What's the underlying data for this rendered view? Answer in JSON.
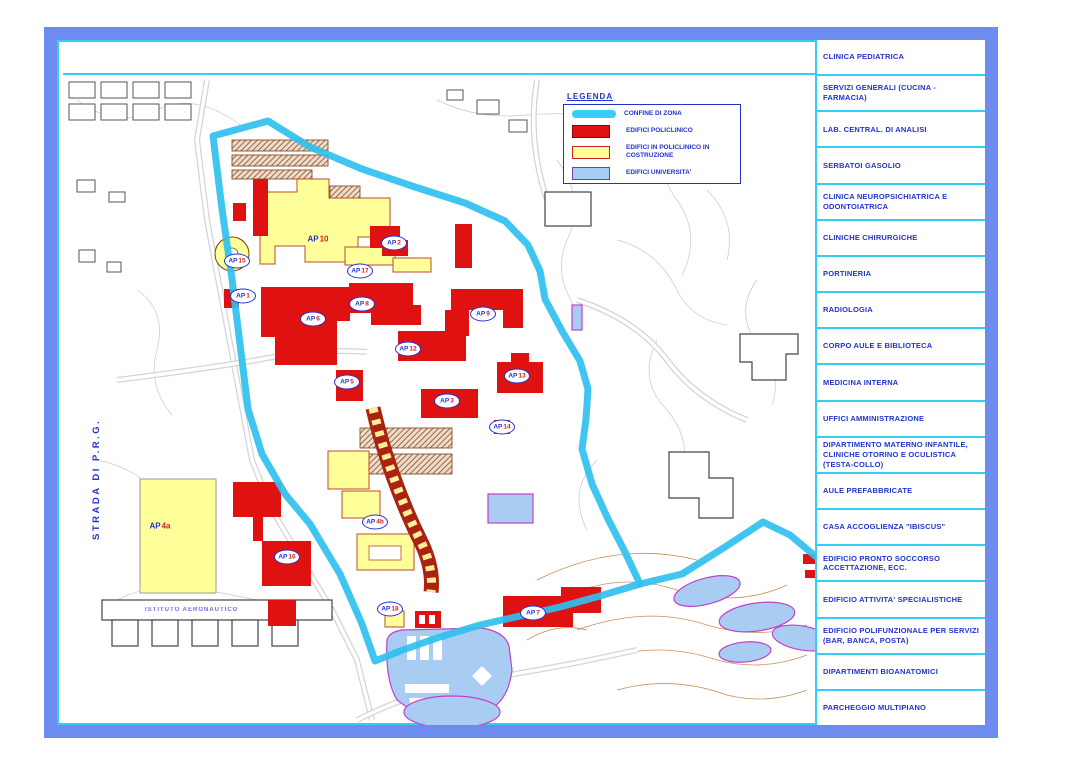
{
  "title": "Planimetria Policlinico - zona ospedaliero-universitaria",
  "colors": {
    "frame_blue": "#6d8cf0",
    "cyan": "#35ccf5",
    "boundary": "#2fc0ee",
    "red": "#e01111",
    "yellow": "#ffff99",
    "blue_bldg": "#a9cdf2",
    "uni_border": "#c040c8",
    "ink_blue": "#2233cc",
    "num_red": "#cc2222"
  },
  "legend": {
    "title": "LEGENDA",
    "items": [
      {
        "swatch": "boundary",
        "label": "CONFINE DI ZONA"
      },
      {
        "swatch": "red",
        "label": "EDIFICI POLICLINICO"
      },
      {
        "swatch": "yellow",
        "label": "EDIFICI IN POLICLINICO IN COSTRUZIONE"
      },
      {
        "swatch": "blue",
        "label": "EDIFICI UNIVERSITA'"
      }
    ]
  },
  "sidebar": {
    "items": [
      "CLINICA PEDIATRICA",
      "SERVIZI GENERALI (CUCINA - FARMACIA)",
      "LAB. CENTRAL. DI ANALISI",
      "SERBATOI GASOLIO",
      "CLINICA NEUROPSICHIATRICA E ODONTOIATRICA",
      "CLINICHE CHIRURGICHE",
      "PORTINERIA",
      "RADIOLOGIA",
      "CORPO AULE E BIBLIOTECA",
      "MEDICINA INTERNA",
      "UFFICI AMMINISTRAZIONE",
      "DIPARTIMENTO MATERNO INFANTILE, CLINICHE OTORINO E OCULISTICA (TESTA-COLLO)",
      "AULE PREFABBRICATE",
      "CASA ACCOGLIENZA \"IBISCUS\"",
      "EDIFICIO PRONTO SOCCORSO ACCETTAZIONE, ECC.",
      "EDIFICIO ATTIVITA' SPECIALISTICHE",
      "EDIFICIO POLIFUNZIONALE PER SERVIZI (BAR, BANCA, POSTA)",
      "DIPARTIMENTI BIOANATOMICI",
      "PARCHEGGIO MULTIPIANO"
    ]
  },
  "map": {
    "texts": {
      "road_label": "STRADA DI P.R.G.",
      "istituto_label": "ISTITUTO AERONAUTICO"
    },
    "markers": [
      {
        "prefix": "AP",
        "num": "10",
        "x": 261,
        "y": 199,
        "style": "plain"
      },
      {
        "prefix": "AP",
        "num": "4a",
        "x": 103,
        "y": 486,
        "style": "plain"
      },
      {
        "prefix": "AP",
        "num": "15",
        "x": 180,
        "y": 221,
        "style": "oval"
      },
      {
        "prefix": "AP",
        "num": "1",
        "x": 186,
        "y": 256,
        "style": "oval"
      },
      {
        "prefix": "AP",
        "num": "2",
        "x": 337,
        "y": 203,
        "style": "oval"
      },
      {
        "prefix": "AP",
        "num": "17",
        "x": 303,
        "y": 231,
        "style": "oval"
      },
      {
        "prefix": "AP",
        "num": "8",
        "x": 305,
        "y": 264,
        "style": "oval"
      },
      {
        "prefix": "AP",
        "num": "6",
        "x": 256,
        "y": 279,
        "style": "oval"
      },
      {
        "prefix": "AP",
        "num": "12",
        "x": 351,
        "y": 309,
        "style": "oval"
      },
      {
        "prefix": "AP",
        "num": "5",
        "x": 290,
        "y": 342,
        "style": "oval"
      },
      {
        "prefix": "AP",
        "num": "3",
        "x": 390,
        "y": 361,
        "style": "oval"
      },
      {
        "prefix": "AP",
        "num": "9",
        "x": 426,
        "y": 274,
        "style": "oval"
      },
      {
        "prefix": "AP",
        "num": "13",
        "x": 460,
        "y": 336,
        "style": "oval"
      },
      {
        "prefix": "AP",
        "num": "14",
        "x": 445,
        "y": 387,
        "style": "oval"
      },
      {
        "prefix": "AP",
        "num": "4b",
        "x": 318,
        "y": 482,
        "style": "oval"
      },
      {
        "prefix": "AP",
        "num": "16",
        "x": 230,
        "y": 517,
        "style": "oval"
      },
      {
        "prefix": "AP",
        "num": "18",
        "x": 333,
        "y": 569,
        "style": "oval"
      },
      {
        "prefix": "AP",
        "num": "7",
        "x": 476,
        "y": 573,
        "style": "oval"
      }
    ]
  }
}
